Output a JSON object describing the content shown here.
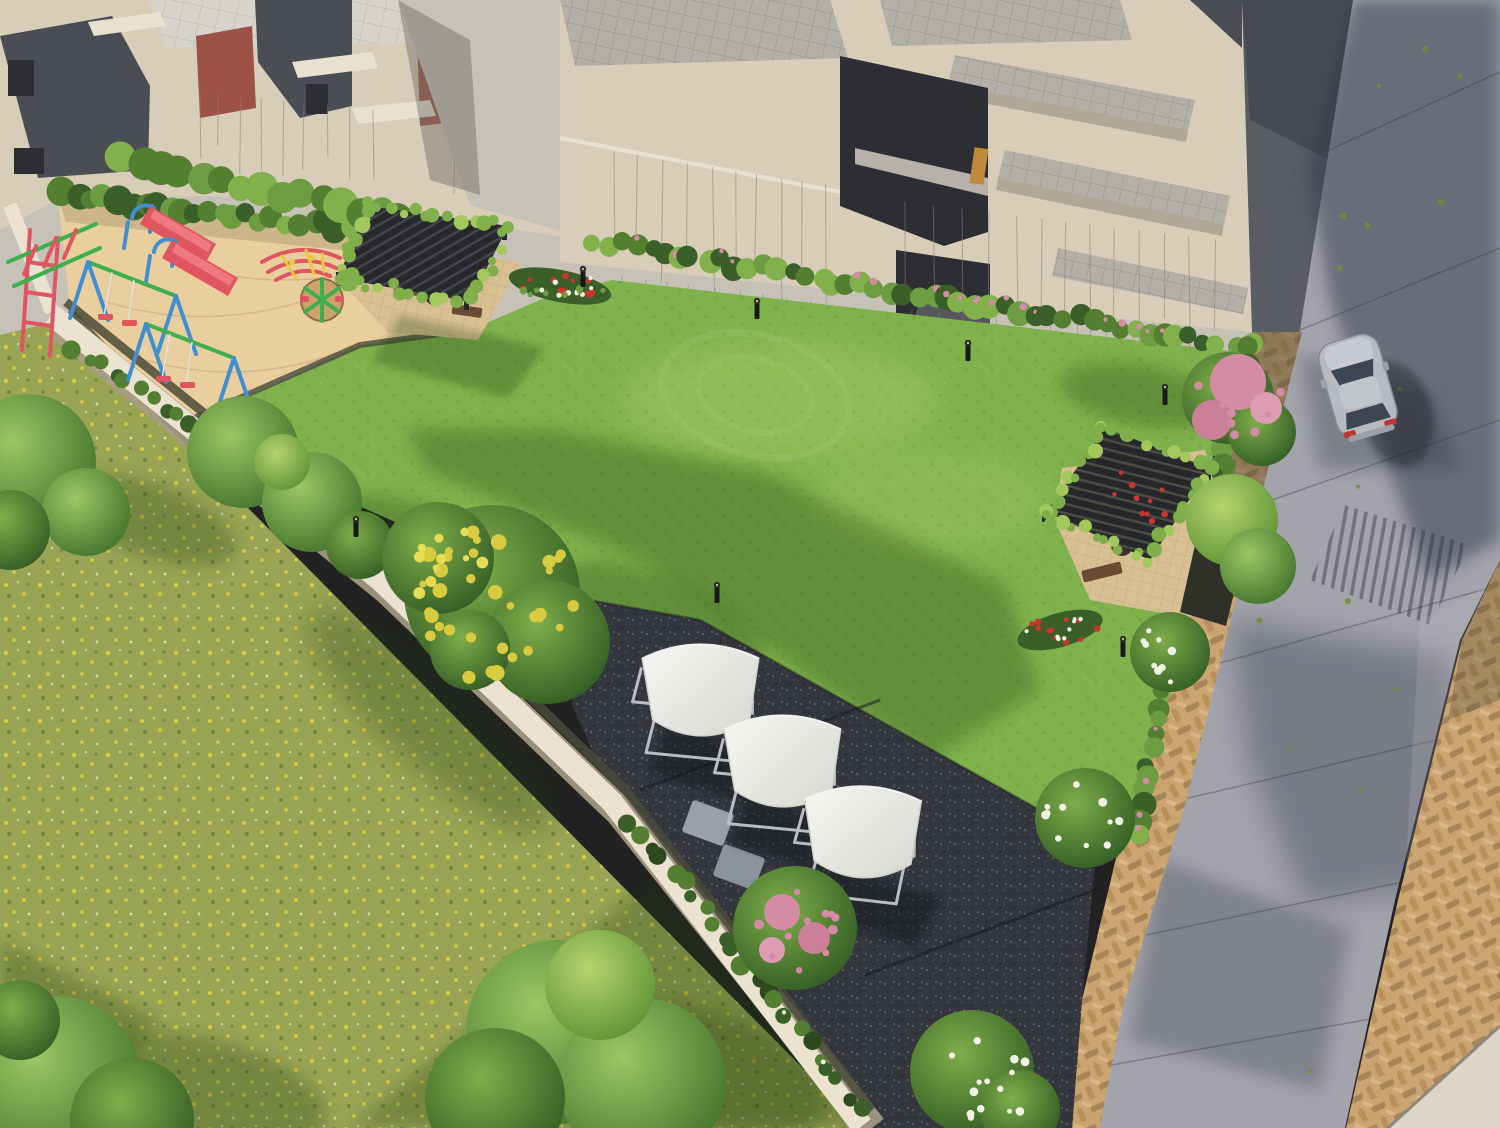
{
  "scene": {
    "title": "Aerial 3D render of a residential society garden with playground, pergolas, shade seats, lawn and road",
    "view": "aerial oblique",
    "lighting": "low warm sunlight from the left casting long shadows"
  },
  "colors": {
    "lawn": "#7fb14c",
    "lawnLight": "#a6cd68",
    "lawnShadow": "#3f6b26",
    "meadow": "#99a455",
    "meadowShadow": "#55703a",
    "flowerYellow": "#e3cf3c",
    "sand": "#e9cf9d",
    "sandShade": "#d3b484",
    "mulch": "#4a4a3a",
    "road": "#a2a3ab",
    "roadShadow": "#33384a",
    "walkway": "#c6c2b8",
    "paver": "#cba571",
    "paverShade": "#7e6950",
    "gravel": "#33363d",
    "stone": "#9aa0a6",
    "wall": "#ebe3d0",
    "wallShade": "#a89c86",
    "building": "#d7cdb8",
    "buildingLight": "#e8e1d0",
    "buildingDark": "#4b4d55",
    "buildingDeep": "#2c2e33",
    "brick": "#9c5244",
    "deck": "#c2beb6",
    "deckLine": "#6e6a64",
    "hedge": "#547f31",
    "hedgeLight": "#82b14c",
    "hedgeDark": "#3a5f28",
    "leaf": "#6d9c42",
    "vine": "#7fae4a",
    "treeYellow": "#d9cb3f",
    "pink": "#d48ca4",
    "red": "#c8362e",
    "white": "#f0f2e4",
    "pergola": "#26282c",
    "canopy": "#efefea",
    "frame": "#b9bcc0",
    "carBody": "#b7bac0",
    "carGlass": "#3c4653",
    "tailLight": "#c03434",
    "bench": "#6b4a33",
    "bollard": "#17191c",
    "playBlue": "#3f8fd2",
    "playGreen": "#3fae4e",
    "playRed": "#e05660",
    "playYellow": "#e8c93e"
  },
  "inventory": {
    "buildings": {
      "label": "cream row-house blocks with rooftop terraces and brick balcony accents",
      "count": 3
    },
    "central_lawn": {
      "label": "manicured green lawn"
    },
    "wild_meadow": {
      "label": "grass plot dotted with yellow wildflowers"
    },
    "playground": {
      "label": "sand playground",
      "equipment": [
        "slide",
        "slide",
        "swing set",
        "swing set",
        "climbing frame",
        "dome climber",
        "merry-go-round"
      ]
    },
    "pergolas": {
      "label": "vine-covered slatted pergolas with benches and planters",
      "count": 2
    },
    "shade_canopies": {
      "label": "white arched canopy seats on gravel terrace",
      "count": 3
    },
    "road": {
      "label": "concrete road with expansion joints and tree shadows"
    },
    "paver_walkways": {
      "label": "tan herringbone brick paver strips"
    },
    "car": {
      "label": "silver hatchback parked on road",
      "count": 1
    },
    "boundary_wall": {
      "label": "white compound wall"
    },
    "bollard_lights": {
      "label": "black garden bollard lights",
      "count": 7
    },
    "trees": {
      "labels": [
        "yellow-blossom tree",
        "pink-blossom trees",
        "white plumeria bushes",
        "green shade trees",
        "flower beds (red/white)"
      ]
    }
  }
}
